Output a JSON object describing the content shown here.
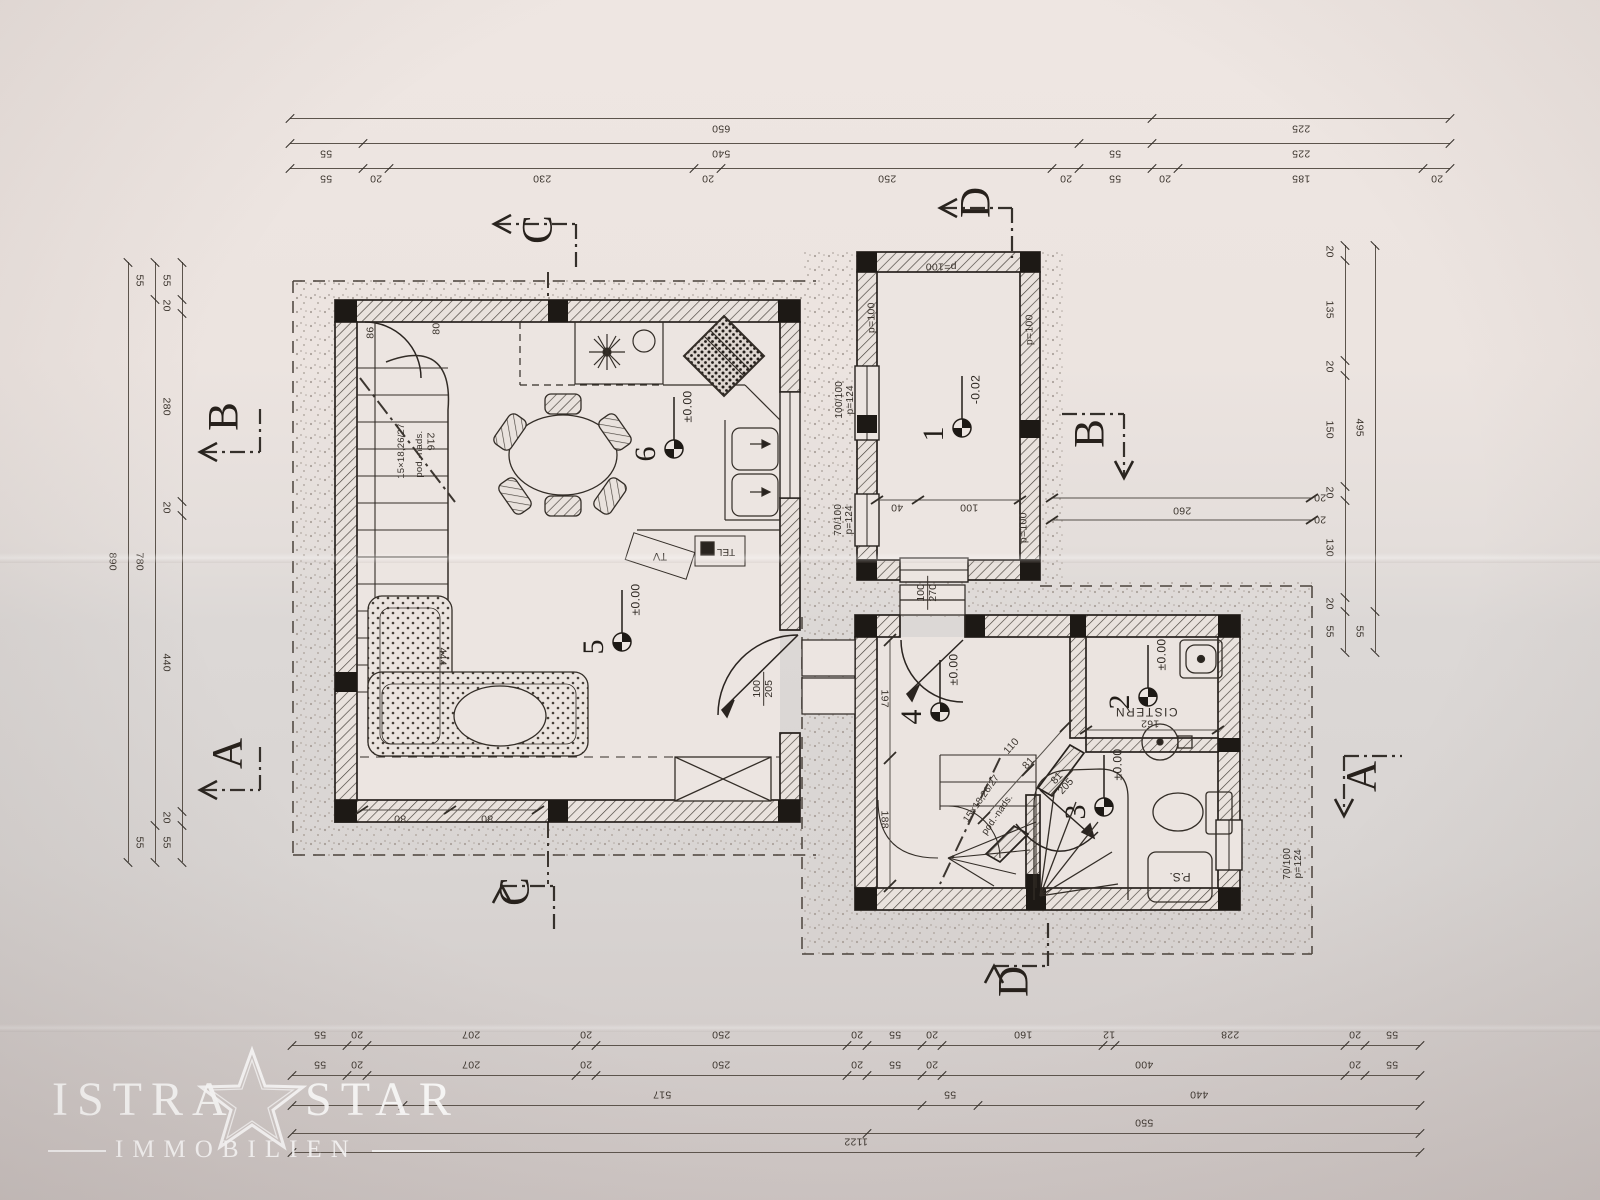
{
  "watermark": {
    "brand_left": "ISTRA",
    "brand_right": "STAR",
    "subtitle": "IMMOBILIEN"
  },
  "sections": {
    "a": "A",
    "b": "B",
    "c": "C",
    "d": "D"
  },
  "rooms": {
    "r1": {
      "num": "1",
      "level": "-0.02"
    },
    "r2": {
      "num": "2",
      "level": "±0.00",
      "name": "CISTERN"
    },
    "r3": {
      "num": "3",
      "level": "±0.00"
    },
    "r4": {
      "num": "4",
      "level": "±0.00"
    },
    "r5": {
      "num": "5",
      "level": "±0.00"
    },
    "r6": {
      "num": "6",
      "level": "±0.00"
    }
  },
  "openings": {
    "door_living": {
      "w": "100",
      "h": "205"
    },
    "door_entry": {
      "w": "100",
      "h": "270"
    },
    "door_bath": {
      "w": "81",
      "h": "205"
    },
    "win_a": {
      "size": "100/100",
      "parapet": "p=124"
    },
    "win_b": {
      "size": "70/100",
      "parapet": "p=124"
    },
    "win_c": {
      "size": "70/100",
      "parapet": "p=124"
    },
    "wall_parapet": "p=100"
  },
  "stairs": {
    "flight": "15×18,26/27",
    "note": "pod.-nads."
  },
  "equipment": {
    "tv": "TV",
    "tel": "TEL",
    "ps": "P.S."
  },
  "dims": {
    "top_row1": [
      650,
      225
    ],
    "top_row2": [
      55,
      540,
      55,
      225
    ],
    "top_row3": [
      55,
      20,
      230,
      20,
      250,
      20,
      55,
      20,
      185,
      20
    ],
    "left_outer": [
      890
    ],
    "left_mid": [
      55,
      780,
      55
    ],
    "left_inner": [
      55,
      20,
      280,
      20,
      440,
      20,
      55
    ],
    "right_outer": [
      495,
      55
    ],
    "right_inner": [
      20,
      135,
      20,
      150,
      20,
      130,
      20,
      55
    ],
    "bottom_row1": [
      55,
      20,
      207,
      20,
      250,
      20,
      55,
      20,
      160,
      12,
      228,
      20,
      55
    ],
    "bottom_row2": [
      55,
      20,
      207,
      20,
      250,
      20,
      55,
      20,
      400,
      20,
      55
    ],
    "bottom_row3": [
      {
        "v": 110,
        "t": ""
      },
      517,
      55,
      440
    ],
    "bottom_row4": [
      {
        "v": 572,
        "t": ""
      },
      550
    ],
    "bottom_row5": [
      1122
    ],
    "annex_width": "260",
    "annex_20a": "20",
    "annex_20b": "20",
    "room1_40": "40",
    "room1_100": "100",
    "cistern_162": "162",
    "hall_197": "197",
    "hall_188": "188",
    "diag_110": "110",
    "diag_81": "81",
    "living_80a": "80",
    "living_80b": "80",
    "stair_86": "86",
    "stair_80": "80",
    "stair_216": "216",
    "living_444": "444"
  }
}
